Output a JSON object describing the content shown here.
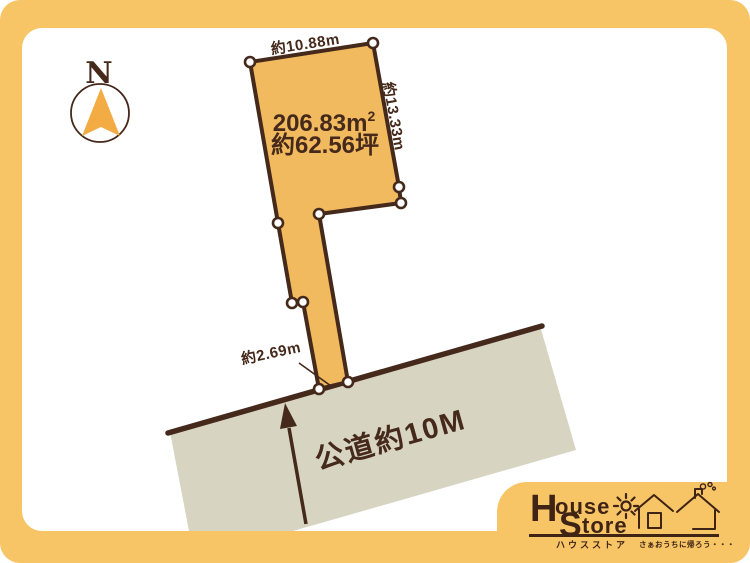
{
  "colors": {
    "card_orange": "#F7C466",
    "plot_fill": "#F1BA5E",
    "outline_brown": "#45291B",
    "road_gray": "#D7D4C1",
    "needle_orange": "#F3AC44",
    "panel_white": "#FFFFFF"
  },
  "compass": {
    "letter": "N"
  },
  "parcel": {
    "edge_top": "約10.88m",
    "edge_right": "約13.33m",
    "frontage": "約2.69m",
    "area_value": "206.83",
    "area_unit": "m",
    "area_sup": "2",
    "area_tsubo": "約62.56坪"
  },
  "road": {
    "label": "公道約10M"
  },
  "logo": {
    "word1_initial": "H",
    "word1_rest": "ouse",
    "word2_initial": "S",
    "word2_rest": "tore",
    "subtitle": "ハウスストア",
    "tagline": "さぁおうちに帰ろう・・・",
    "icons": [
      "sun-icon",
      "houses-icon"
    ]
  }
}
